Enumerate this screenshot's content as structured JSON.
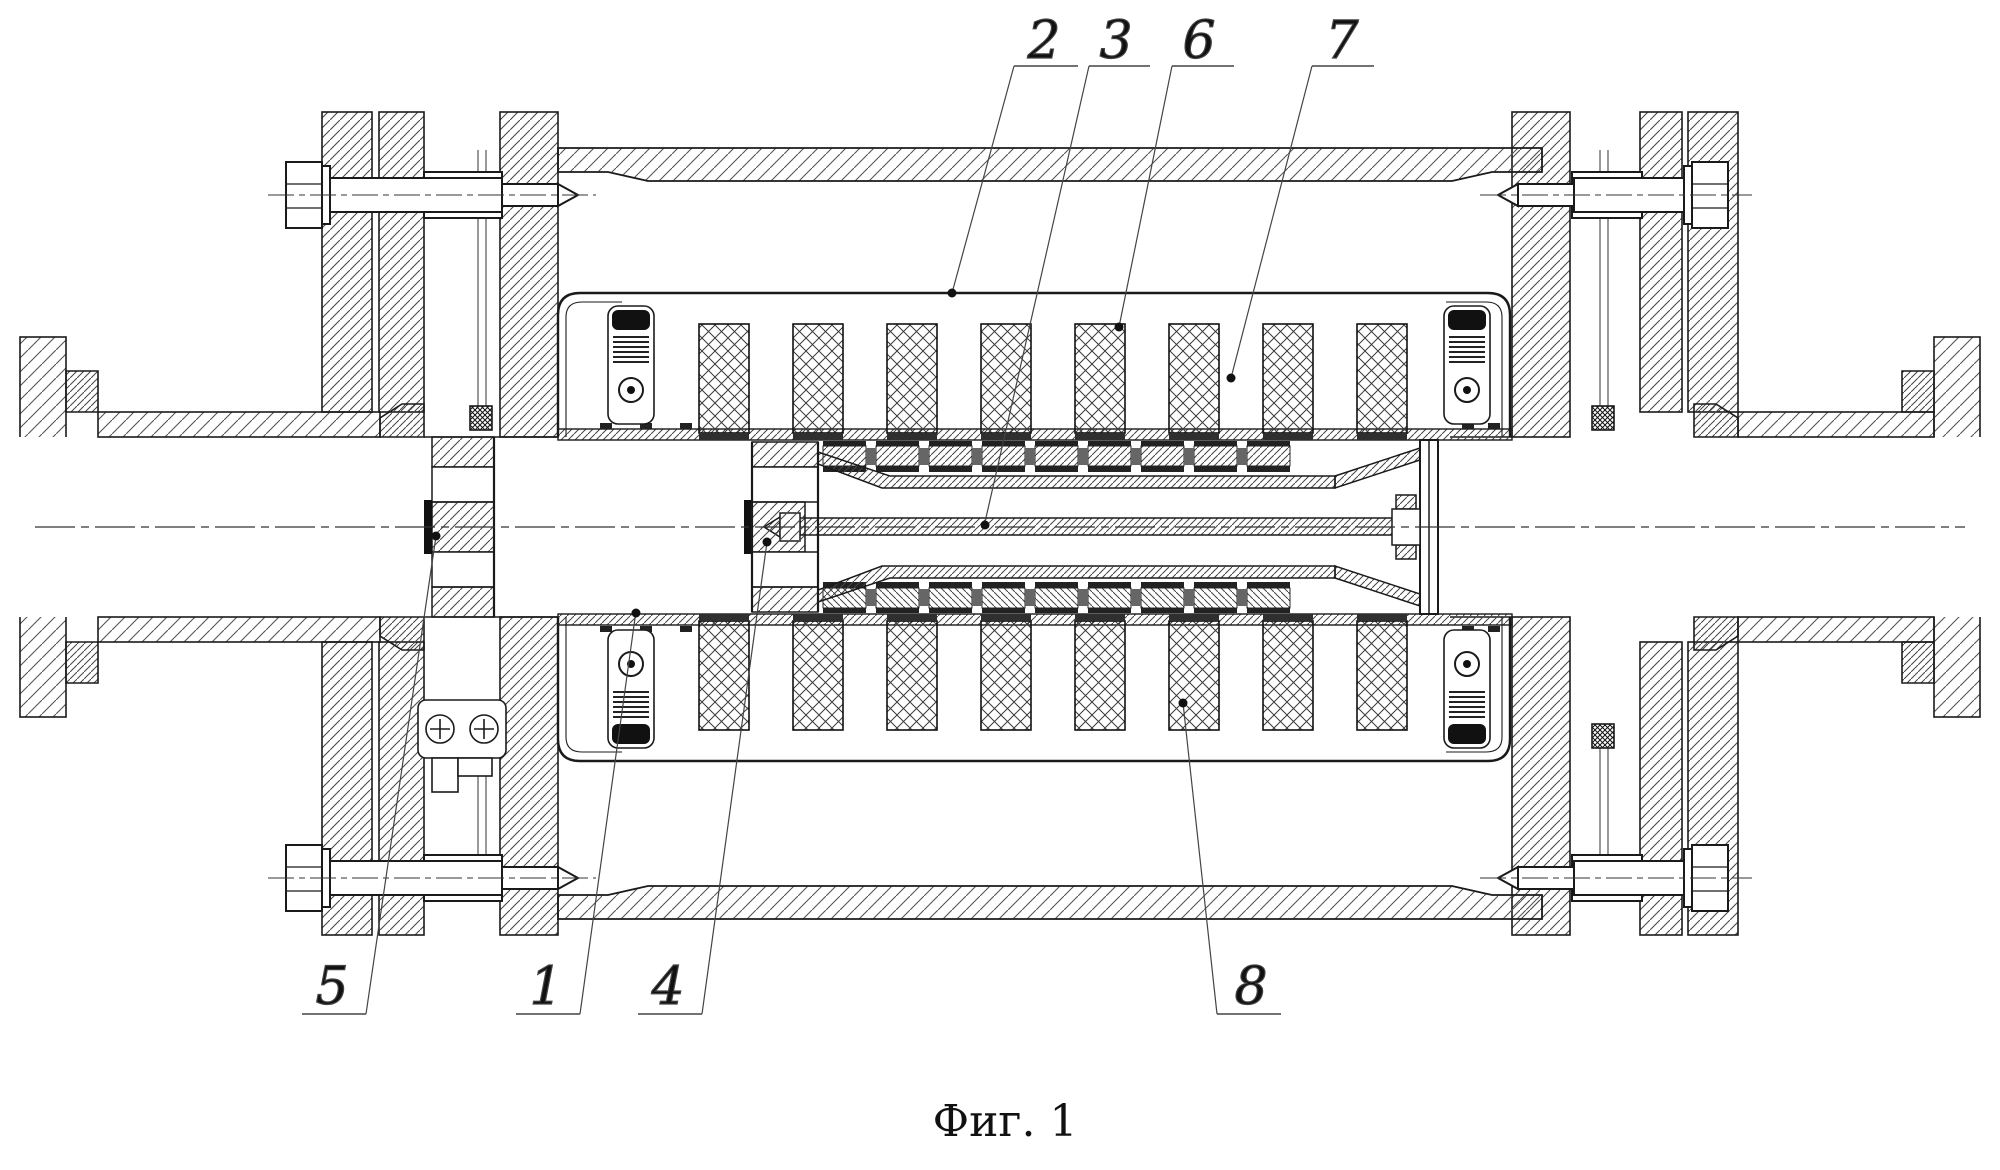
{
  "figure": {
    "caption": "Фиг. 1",
    "type": "patent_drawing_longitudinal_section",
    "background_color": "#ffffff",
    "line_color": "#1a1a1a"
  },
  "callouts": {
    "c1": {
      "label": "1"
    },
    "c2": {
      "label": "2"
    },
    "c3": {
      "label": "3"
    },
    "c4": {
      "label": "4"
    },
    "c5": {
      "label": "5"
    },
    "c6": {
      "label": "6"
    },
    "c7": {
      "label": "7"
    },
    "c8": {
      "label": "8"
    }
  }
}
